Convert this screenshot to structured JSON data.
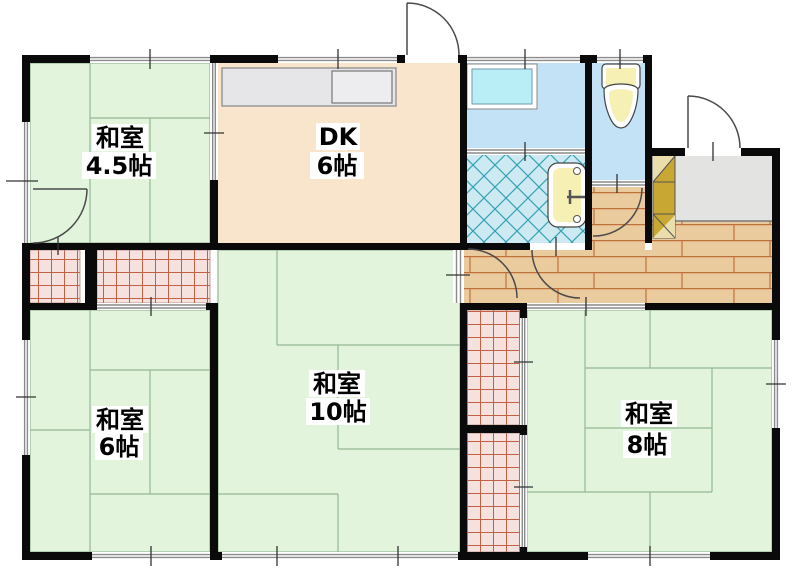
{
  "document_type": "floor-plan",
  "rooms": [
    {
      "id": "washitsu-4-5",
      "name": "和室",
      "size": "4.5帖",
      "floor": "tatami"
    },
    {
      "id": "dining-kitchen",
      "name": "DK",
      "size": "6帖",
      "floor": "flooring"
    },
    {
      "id": "washitsu-6",
      "name": "和室",
      "size": "6帖",
      "floor": "tatami"
    },
    {
      "id": "washitsu-10",
      "name": "和室",
      "size": "10帖",
      "floor": "tatami"
    },
    {
      "id": "washitsu-8",
      "name": "和室",
      "size": "8帖",
      "floor": "tatami"
    }
  ],
  "unlabeled_areas": [
    "washroom",
    "bathroom",
    "toilet",
    "entrance",
    "hallway",
    "closet-northwest-small",
    "closet-northwest-wide",
    "closet-east-upper",
    "closet-east-lower"
  ],
  "fixtures": [
    "kitchen-counter",
    "kitchen-sink",
    "washing-machine-pan",
    "bathtub",
    "toilet-bowl",
    "shoe-cabinet"
  ],
  "colors": {
    "wall": "#0a0a0a",
    "tatami": "#e2f4dc",
    "tatami-line": "#94b894",
    "dk": "#f9e5cb",
    "water": "#c3e2f6",
    "tile": "#cde9f2",
    "tile-line": "#35a3b5",
    "wood": "#eacb9d",
    "wood-line": "#c0713b",
    "closet": "#f5e1de",
    "closet-line": "#c35f43",
    "tataki": "#e3e3e2",
    "fixture": "#f6f0b4",
    "pan": "#b9eef7",
    "counter": "#e6e6e8",
    "cabinet": "#c9a733",
    "arc": "#4a4a4a"
  }
}
